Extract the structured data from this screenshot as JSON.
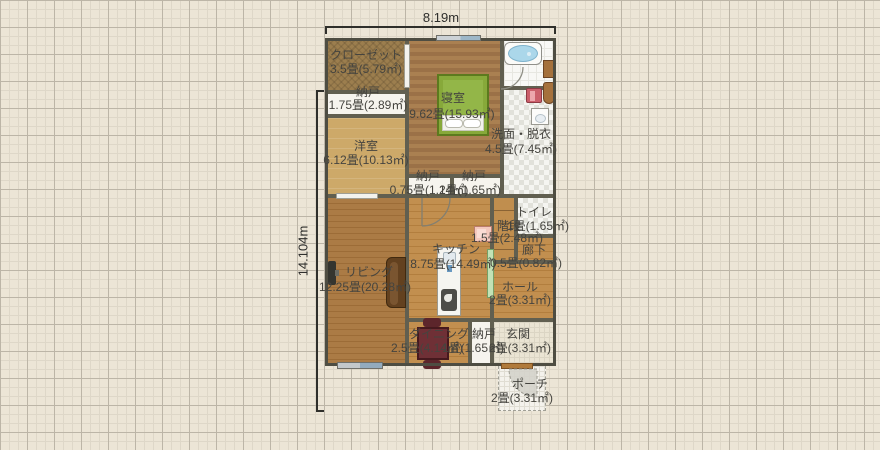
{
  "canvas": {
    "background": "#ece5d6",
    "grid_minor_color": "#ded7c8",
    "grid_major_color": "#bcb5a7",
    "wall_color": "#55534a"
  },
  "dimensions": {
    "width_label": "8.19m",
    "height_label": "14.104m"
  },
  "rooms": [
    {
      "name": "クローゼット",
      "area": "3.5畳(5.79㎡)"
    },
    {
      "name": "納戸",
      "area": "1.75畳(2.89㎡)"
    },
    {
      "name": "寝室",
      "area": "9.62畳(15.93㎡)"
    },
    {
      "name": "洋室",
      "area": "6.12畳(10.13㎡)"
    },
    {
      "name": "洗面・脱衣",
      "area": "4.5畳(7.45㎡)"
    },
    {
      "name": "納戸",
      "area": "0.75畳(1.24㎡)"
    },
    {
      "name": "納戸",
      "area": "1畳(1.65㎡)"
    },
    {
      "name": "トイレ",
      "area": "1畳(1.65㎡)"
    },
    {
      "name": "階段",
      "area": "1.5畳(2.48㎡)"
    },
    {
      "name": "廊下",
      "area": "0.5畳(0.82㎡)"
    },
    {
      "name": "キッチン",
      "area": "8.75畳(14.49㎡)"
    },
    {
      "name": "リビング",
      "area": "12.25畳(20.28㎡)"
    },
    {
      "name": "ホール",
      "area": "2畳(3.31㎡)"
    },
    {
      "name": "ダイニング",
      "area": "2.5畳(4.14㎡)"
    },
    {
      "name": "納戸",
      "area": "1畳(1.65㎡)"
    },
    {
      "name": "玄関",
      "area": "2畳(3.31㎡)"
    },
    {
      "name": "ポーチ",
      "area": "2畳(3.31㎡)"
    }
  ],
  "icons": [
    "bathtub-icon",
    "vanity-icon",
    "toilet-fixture-icon",
    "washing-machine-icon",
    "washbasin-icon",
    "bed-icon",
    "kitchen-counter-icon",
    "sink-icon",
    "stove-icon",
    "appliance-icon",
    "sliding-door",
    "sofa-icon",
    "tv-icon",
    "dining-table-icon",
    "chair-icon",
    "window",
    "door-arc-icon",
    "entrance-door",
    "porch-swing-icon"
  ],
  "colors": {
    "bed_green": "#87a93a",
    "bathtub_blue": "#abd7ea",
    "washer_red": "#cb5f6b",
    "sofa_brown": "#63411f",
    "table_maroon": "#6f3036",
    "sliding_door_green": "#c2e2b6",
    "wood_floor": "#c28f4f"
  }
}
